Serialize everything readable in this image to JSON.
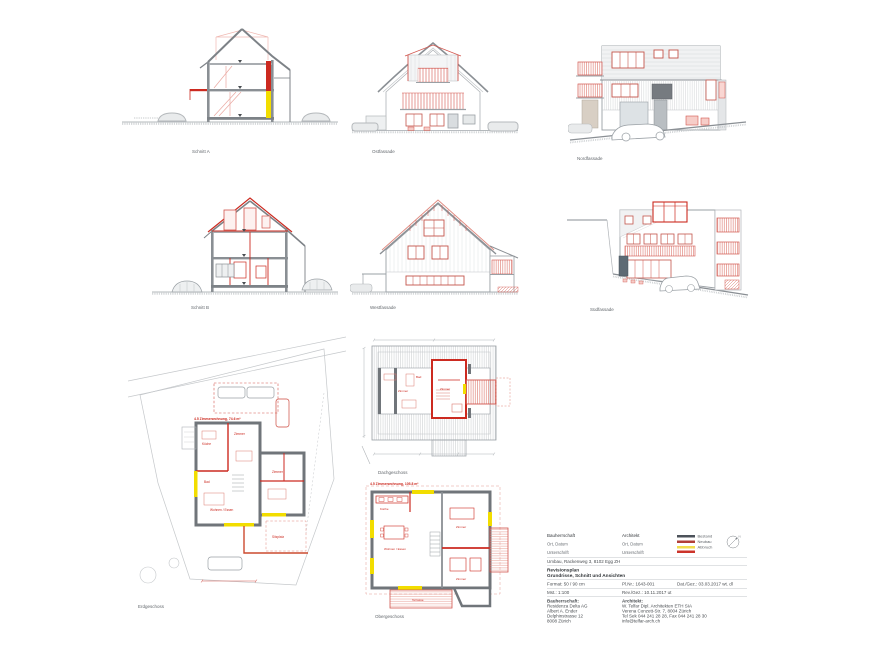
{
  "sheet": {
    "title": "Revisionsplan — Grundrisse, Schnitt und Ansichten"
  },
  "colors": {
    "existing_gray": "#8a8f94",
    "new_red": "#cc2a20",
    "demolition_yellow": "#f2dd00"
  },
  "drawings": {
    "schnitt_a": {
      "label": "Schnitt A"
    },
    "ostfassade": {
      "label": "Ostfassade"
    },
    "nordfassade": {
      "label": "Nordfassade"
    },
    "schnitt_b": {
      "label": "Schnitt B"
    },
    "westfassade": {
      "label": "Westfassade"
    },
    "suedfassade": {
      "label": "Südfassade"
    },
    "erdgeschoss": {
      "label": "Erdgeschoss",
      "flat_label": "4.5 Zimmerwohnung, 74.6 m²",
      "rooms": [
        "Küche",
        "Zimmer",
        "Bad",
        "Wohnen / Essen",
        "Zimmer",
        "Sitzplatz"
      ]
    },
    "dachgeschoss": {
      "label": "Dachgeschoss",
      "rooms": [
        "Zimmer",
        "Bad",
        "Zimmer"
      ]
    },
    "obergeschoss": {
      "label": "Obergeschoss",
      "flat_label": "4.5 Zimmerwohnung, 105.8 m²",
      "rooms": [
        "Küche",
        "Wohnen / Essen",
        "Zimmer",
        "Zimmer",
        "Terrasse"
      ]
    }
  },
  "titleblock": {
    "sig_left": {
      "title": "Bauherrschaft",
      "l1": "Ort, Datum",
      "l2": "Unterschrift"
    },
    "sig_right": {
      "title": "Architekt",
      "l1": "Ort, Datum",
      "l2": "Unterschrift"
    },
    "legend": {
      "items": [
        {
          "label": "Bestand",
          "color": "#4c525a"
        },
        {
          "label": "Neubau",
          "color": "#b23f38"
        },
        {
          "label": "Abbruch",
          "color": "#f2dd4e"
        },
        {
          "label": "",
          "color": "#cc342a"
        }
      ]
    },
    "compass_label": "N",
    "project": "Umbau, Rackenweg 3, 8102 Egg ZH",
    "plan_type": "Revisionsplan",
    "plan_title": "Grundrisse, Schnitt und Ansichten",
    "format_label": "Format: 50 / 90 cm",
    "plnr_label": "Pl.Nr.: 1643-001",
    "date_label": "Dat./Gez.: 03.03.2017 wt. dl",
    "scale_label": "Mst.: 1:100",
    "rev_label": "Rev./Gez.: 10.11.2017 ut",
    "client": {
      "title": "Bauherrschaft:",
      "line0": "Residenza Delta AG",
      "line1": "Albert A. Ender",
      "line2": "Delphinstrasse 12",
      "line3": "8008 Zürich"
    },
    "architect": {
      "title": "Architekt:",
      "line0": "W. Telfar Dipl. Architekten ETH SIA",
      "line1": "Verena Conzett-Str. 7, 8004 Zürich",
      "line2": "Tel Sek 044 241 28 28, Fax 044 241 28 30",
      "line3": "info@telfar-arch.ch"
    }
  }
}
